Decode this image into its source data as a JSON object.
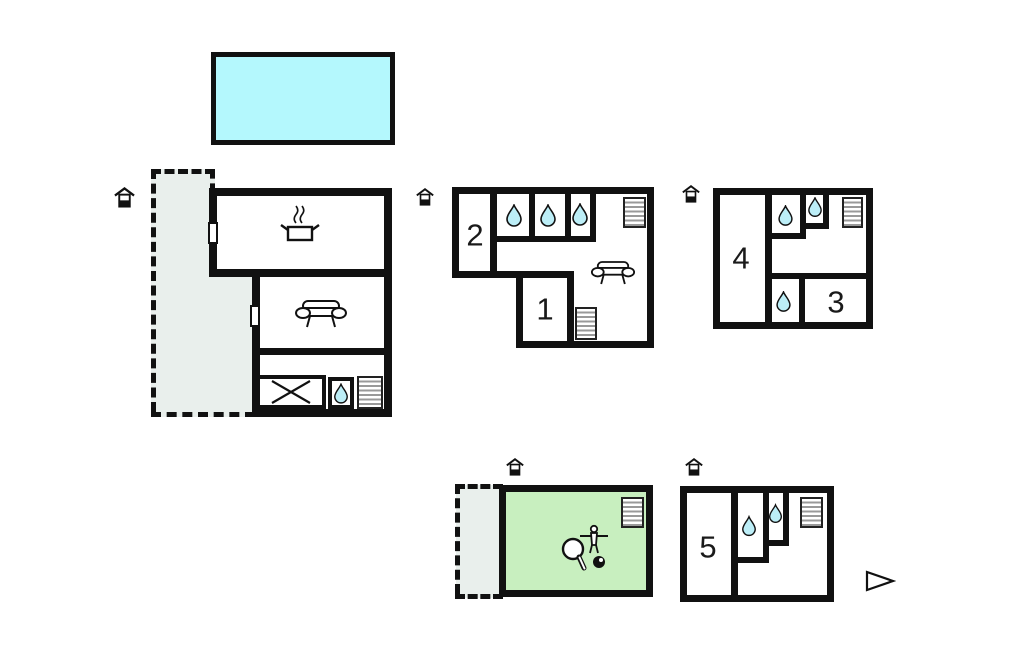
{
  "floorplan": {
    "room_labels": {
      "room1": "1",
      "room2": "2",
      "room3": "3",
      "room4": "4",
      "room5": "5"
    },
    "colors": {
      "pool": "#b4f8fd",
      "water_drop": "#bceef7",
      "games_room": "#c8efbf",
      "terrace": "#e9efec",
      "wall": "#111111",
      "stair_step": "#999999"
    },
    "icons": {
      "entrance": "house-entrance-icon",
      "water_drop": "water-drop-icon",
      "stairs": "stairs-icon",
      "cooking_pot": "pot-with-steam-icon",
      "sofa": "sofa-icon",
      "table": "crossed-table-icon",
      "games": "table-tennis-foosball-icon",
      "flag": "direction-flag-icon"
    }
  }
}
